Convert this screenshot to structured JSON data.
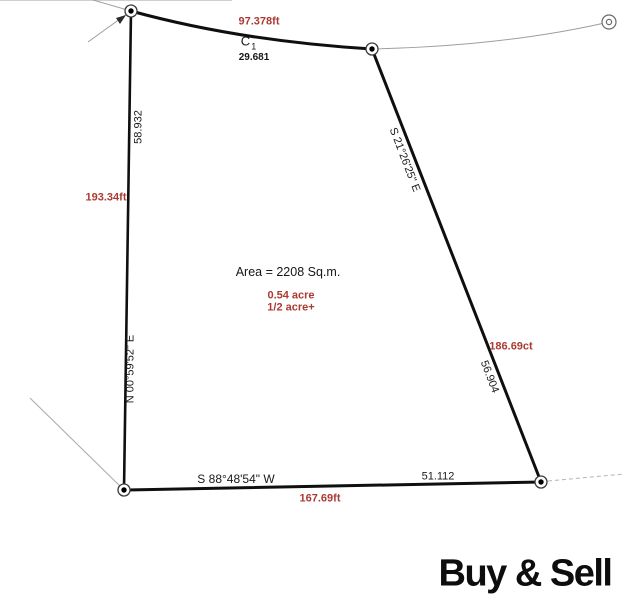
{
  "title": "Land survey parcel plot",
  "parcel": {
    "area": "Area = 2208 Sq.m.",
    "area_acre": "0.54 acre",
    "area_half_acre": "1/2 acre+"
  },
  "edges": {
    "top_length_ft": "97.378ft",
    "curve_label_main": "C",
    "curve_label_sub": "1",
    "curve_length": "29.681",
    "left_length": "58.932",
    "left_length_ft": "193.34ft",
    "left_bearing": "N 00°59'52\" E",
    "right_bearing": "S 21°26'25\" E",
    "right_length_ft": "186.69ct",
    "right_length": "56.904",
    "bottom_bearing": "S 88°48'54\" W",
    "bottom_length": "51.112",
    "bottom_length_ft": "167.69ft"
  },
  "branding": {
    "logo_text": "Buy & Sell"
  },
  "colors": {
    "measurement_red": "#ab3a33",
    "boundary_black": "#0f0f0f",
    "reference_gray": "#9e9e9e"
  }
}
